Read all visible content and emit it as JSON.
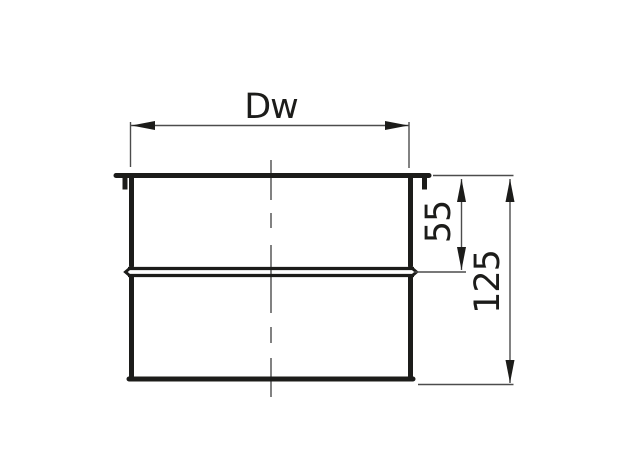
{
  "drawing": {
    "labels": {
      "diameter": "Dw",
      "upper_depth": "55",
      "overall_height": "125"
    },
    "colors": {
      "outline": "#1c1c1a",
      "dimension_lines": "#4c4c4c",
      "background": "#ffffff"
    }
  }
}
